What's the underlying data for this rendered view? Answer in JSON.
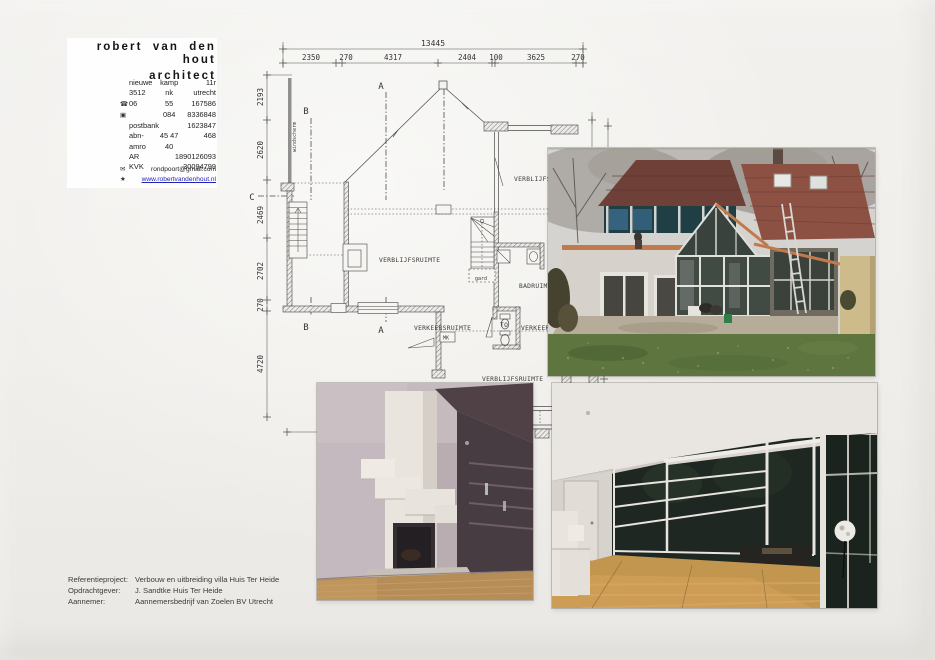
{
  "letterhead": {
    "title_line1": "robert van den hout",
    "title_line2": "architect",
    "rows": [
      {
        "icon": "",
        "c1": "nieuwe",
        "c2": "kamp",
        "c3": "11r"
      },
      {
        "icon": "",
        "c1": "3512",
        "c2": "nk",
        "c3": "utrecht"
      },
      {
        "icon": "☎",
        "c1": "06",
        "c2": "55",
        "c3": "167586"
      },
      {
        "icon": "▣",
        "c1": "",
        "c2": "084",
        "c3": "8336848"
      },
      {
        "icon": "",
        "c1": "postbank",
        "c2": "",
        "c3": "1623847"
      },
      {
        "icon": "",
        "c1": "abn-amro",
        "c2": "45 47 40",
        "c3": "468"
      },
      {
        "icon": "",
        "c1": "AR",
        "c2": "",
        "c3": "1890126093"
      },
      {
        "icon": "",
        "c1": "KVK",
        "c2": "",
        "c3": "30094799"
      }
    ],
    "email_icon": "✉",
    "email": "rondpoort@gmail.com",
    "web_icon": "★",
    "website": "www.robertvandenhout.nl",
    "link_color": "#2323bb"
  },
  "plan": {
    "dim_total": "13445",
    "dims_top": [
      "2350",
      "270",
      "4317",
      "2404",
      "100",
      "3625",
      "270"
    ],
    "dims_left": [
      "2193",
      "2620",
      "2469",
      "2702",
      "270",
      "4720"
    ],
    "rooms": {
      "living": "VERBLIJFSRUIMTE",
      "living_right": "VERBLIJFSRUIMTE",
      "living_bottom": "VERBLIJFSRUIMTE",
      "bath": "BADRUIMTE",
      "hall": "VERKEERSRUIMTE",
      "hall_right": "VERKEERSRUIMTE",
      "toilet": "TO",
      "wardrobe": "gard",
      "meter": "MK",
      "windscreen": "windscherm"
    },
    "markers": {
      "a": "A",
      "b": "B",
      "c": "C"
    }
  },
  "footer": {
    "rows": [
      {
        "label": "Referentieproject:",
        "value": "Verbouw en uitbreiding villa Huis Ter Heide"
      },
      {
        "label": "Opdrachtgever:",
        "value": "J. Sandtke Huis Ter Heide"
      },
      {
        "label": "Aannemer:",
        "value": "Aannemersbedrijf van Zoelen BV Utrecht"
      }
    ]
  }
}
